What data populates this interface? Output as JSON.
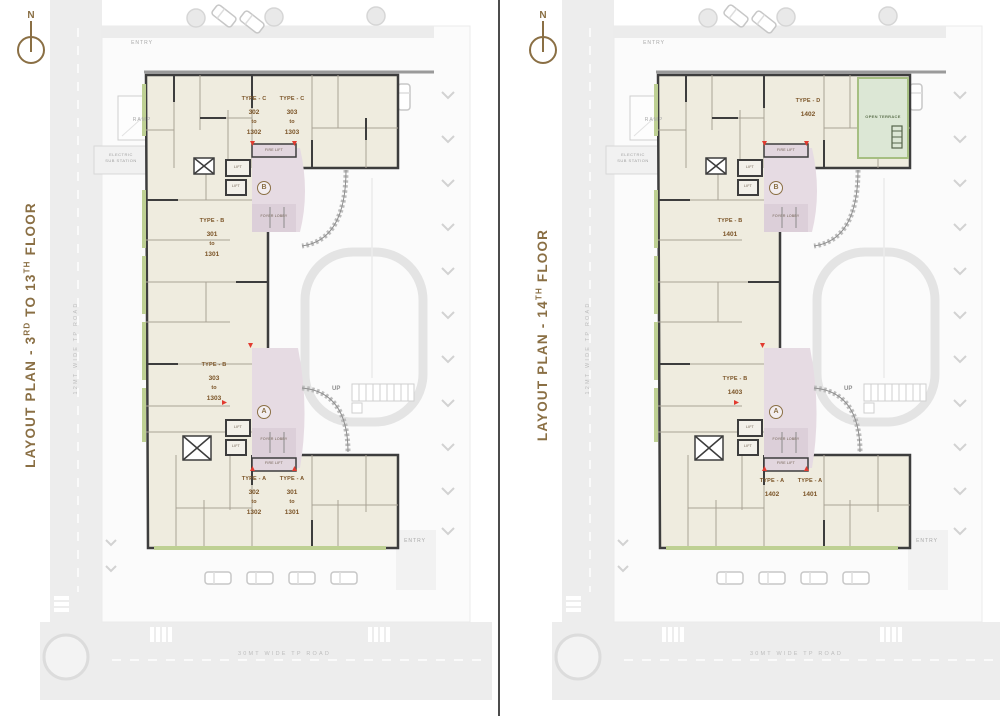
{
  "colors": {
    "accent_brown": "#8a6f44",
    "unit_text_brown": "#7a5326",
    "wall_dark": "#3d3d3d",
    "unit_fill": "#efecdf",
    "lobby_fill": "#e6dbe3",
    "balcony_green": "#bed093",
    "terrace_green": "#dce7d5",
    "road_gray": "#ededed",
    "red_marker": "#e23b30",
    "divider": "#4c4c4c"
  },
  "plans": [
    {
      "title": {
        "pre": "LAYOUT PLAN - 3",
        "sup1": "RD",
        "mid": " TO 13",
        "sup2": "TH",
        "post": " FLOOR"
      },
      "compass_n": "N",
      "site": {
        "entry_top": "ENTRY",
        "ramp": "RAMP",
        "substation_line1": "ELECTRIC",
        "substation_line2": "SUB STATION",
        "entry_bottom": "ENTRY",
        "road_bottom": "30MT WIDE TP ROAD",
        "road_left": "12MT WIDE TP ROAD",
        "up": "UP"
      },
      "lobby_top": {
        "letter": "B",
        "lift1": "LIFT",
        "lift2": "LIFT",
        "fire_lift": "FIRE LIFT",
        "foyer": "FOYER LOBBY"
      },
      "lobby_bottom": {
        "letter": "A",
        "lift1": "LIFT",
        "lift2": "LIFT",
        "fire_lift": "FIRE LIFT",
        "foyer": "FOYER LOBBY"
      },
      "units": [
        {
          "type": "TYPE - C",
          "n1": "302",
          "mid": "to",
          "n2": "1302"
        },
        {
          "type": "TYPE - C",
          "n1": "303",
          "mid": "to",
          "n2": "1303"
        },
        {
          "type": "TYPE - B",
          "n1": "301",
          "mid": "to",
          "n2": "1301"
        },
        {
          "type": "TYPE - B",
          "n1": "303",
          "mid": "to",
          "n2": "1303"
        },
        {
          "type": "TYPE - A",
          "n1": "302",
          "mid": "to",
          "n2": "1302"
        },
        {
          "type": "TYPE - A",
          "n1": "301",
          "mid": "to",
          "n2": "1301"
        }
      ]
    },
    {
      "title": {
        "pre": "LAYOUT PLAN - 14",
        "sup1": "TH",
        "mid": "",
        "sup2": "",
        "post": " FLOOR"
      },
      "compass_n": "N",
      "site": {
        "entry_top": "ENTRY",
        "ramp": "RAMP",
        "substation_line1": "ELECTRIC",
        "substation_line2": "SUB STATION",
        "entry_bottom": "ENTRY",
        "road_bottom": "30MT WIDE TP ROAD",
        "road_left": "12MT WIDE TP ROAD",
        "up": "UP"
      },
      "lobby_top": {
        "letter": "B",
        "lift1": "LIFT",
        "lift2": "LIFT",
        "fire_lift": "FIRE LIFT",
        "foyer": "FOYER LOBBY"
      },
      "lobby_bottom": {
        "letter": "A",
        "lift1": "LIFT",
        "lift2": "LIFT",
        "fire_lift": "FIRE LIFT",
        "foyer": "FOYER LOBBY"
      },
      "terrace": {
        "label": "OPEN TERRACE"
      },
      "units": [
        {
          "type": "TYPE - D",
          "n1": "1402",
          "mid": "",
          "n2": ""
        },
        {
          "type": "TYPE - B",
          "n1": "1401",
          "mid": "",
          "n2": ""
        },
        {
          "type": "TYPE - B",
          "n1": "1403",
          "mid": "",
          "n2": ""
        },
        {
          "type": "TYPE - A",
          "n1": "1402",
          "mid": "",
          "n2": ""
        },
        {
          "type": "TYPE - A",
          "n1": "1401",
          "mid": "",
          "n2": ""
        }
      ]
    }
  ]
}
